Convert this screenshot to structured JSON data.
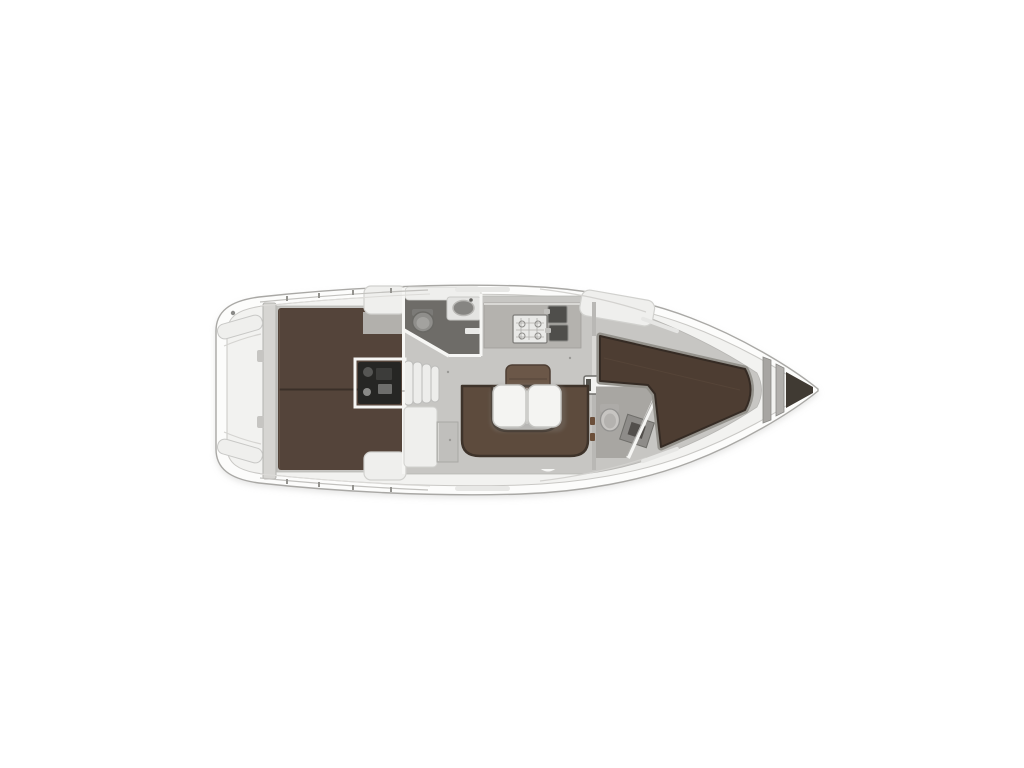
{
  "colors": {
    "page_bg": "#ffffff",
    "hull_fill": "#fcfcfb",
    "hull_stroke": "#a9a8a5",
    "hull_shadow": "#c9c9c7",
    "deck_fill": "#f2f2f0",
    "deck_line": "#c9c8c5",
    "deck_detail": "#c2c1be",
    "interior_floor": "#c7c6c3",
    "wall_white": "#f6f6f4",
    "transom": "#d6d5d2",
    "helm_seat": "#efefed",
    "aft_berth": "#54443a",
    "berth_seam": "#3a2f28",
    "wardrobe_front": "#bdbcb9",
    "cabinet": "#efefed",
    "cabinet_stroke": "#d1d1ce",
    "engine_block": "#262624",
    "engine_detail": "#6e6e6c",
    "steps": "#ededeb",
    "steps_stroke": "#bcbcba",
    "heads_aft_floor": "#6e6c68",
    "heads_fwd_floor": "#a8a6a2",
    "toilet_aft": "#8f8e8b",
    "toilet_fwd": "#c7c5c2",
    "sink_basin": "#868582",
    "galley_counter": "#b4b2ae",
    "stove": "#e9e9e7",
    "sink_dark": "#4f4e4b",
    "settee": "#5d4b3d",
    "settee_outline": "#3e332a",
    "side_seat": "#6b5748",
    "table": "#f4f4f2",
    "table_stroke": "#c6c6c3",
    "partition": "#c0bfbc",
    "mast_box": "#f2f2f0",
    "bulkhead": "#b9b8b5",
    "hinge_brown": "#6b4f3a",
    "fwd_berth": "#4d3d32",
    "berth_rim": "#94928c",
    "fixture_dark": "#524f4c",
    "fwd_sink_unit": "#8e8c89",
    "bow_bar": "#a7a5a2",
    "bow_dark": "#403a33"
  },
  "regions": [
    "swim-platform",
    "helm-seats",
    "aft-double-berths",
    "engine-compartment",
    "companionway-steps",
    "aft-heads",
    "galley",
    "salon-settee",
    "folding-table",
    "navigation-seat",
    "mast-step",
    "forward-heads",
    "forward-v-berth",
    "anchor-locker"
  ]
}
